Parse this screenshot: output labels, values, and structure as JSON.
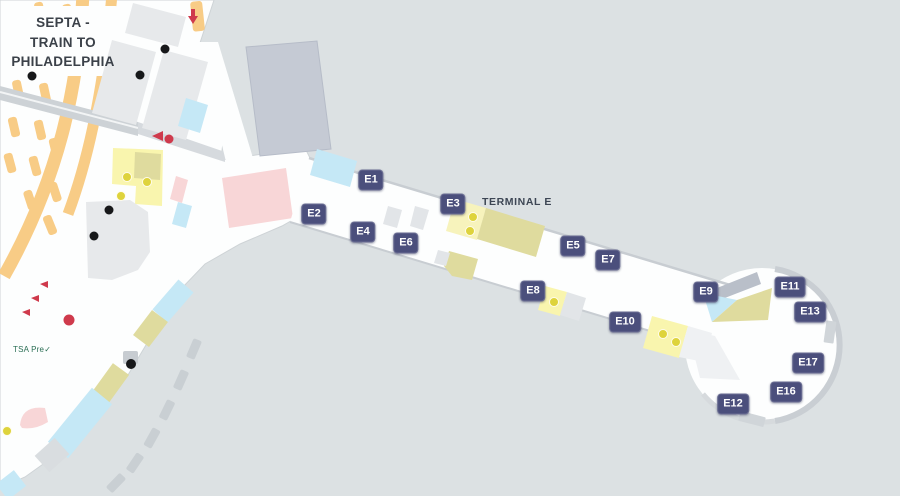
{
  "map": {
    "septa_label": {
      "line1": "SEPTA -",
      "line2": "TRAIN TO",
      "line3": "PHILADELPHIA"
    },
    "terminal_label": "TERMINAL E",
    "tsa_label": "TSA Pre✓",
    "gates": [
      {
        "id": "E1",
        "label": "E1",
        "x": 371,
        "y": 180
      },
      {
        "id": "E2",
        "label": "E2",
        "x": 314,
        "y": 214
      },
      {
        "id": "E3",
        "label": "E3",
        "x": 453,
        "y": 204
      },
      {
        "id": "E4",
        "label": "E4",
        "x": 363,
        "y": 232
      },
      {
        "id": "E5",
        "label": "E5",
        "x": 573,
        "y": 246
      },
      {
        "id": "E6",
        "label": "E6",
        "x": 406,
        "y": 243
      },
      {
        "id": "E7",
        "label": "E7",
        "x": 608,
        "y": 260
      },
      {
        "id": "E8",
        "label": "E8",
        "x": 533,
        "y": 291
      },
      {
        "id": "E9",
        "label": "E9",
        "x": 706,
        "y": 292
      },
      {
        "id": "E10",
        "label": "E10",
        "x": 625,
        "y": 322
      },
      {
        "id": "E11",
        "label": "E11",
        "x": 790,
        "y": 287
      },
      {
        "id": "E12",
        "label": "E12",
        "x": 733,
        "y": 404
      },
      {
        "id": "E13",
        "label": "E13",
        "x": 810,
        "y": 312
      },
      {
        "id": "E16",
        "label": "E16",
        "x": 786,
        "y": 392
      },
      {
        "id": "E17",
        "label": "E17",
        "x": 808,
        "y": 363
      }
    ],
    "colors": {
      "bg": "#dce1e3",
      "walkable": "#fdfefe",
      "navy": "#4b4f7c",
      "orange": "#f8cc86",
      "yellow": "#f9f5ae",
      "khaki": "#dfdb9e",
      "blue": "#c5e8f6",
      "pink": "#f8d6d7",
      "building": "#e7e9eb",
      "garage": "#c5cad4",
      "grayline": "#c8cdd2",
      "red": "#cf3a4c",
      "black-dot": "#17181a",
      "yellow-dot": "#ded33c",
      "text-dark": "#3b4149",
      "green": "#2a6e54"
    }
  }
}
